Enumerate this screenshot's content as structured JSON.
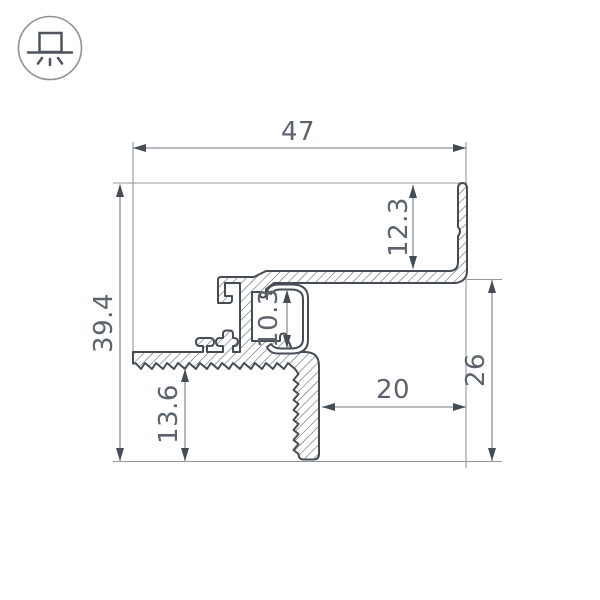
{
  "drawing": {
    "type": "profile-cross-section",
    "icon": "recessed-light-icon",
    "dimensions": {
      "total_width": "47",
      "total_height": "39.4",
      "back_wall_height": "12.3",
      "channel_opening": "10.3",
      "flange_to_base": "13.6",
      "leg_inset": "20",
      "right_drop": "26"
    },
    "colors": {
      "outline": "#454c54",
      "dimension_line": "#8b9299",
      "text": "#5c636c",
      "hatch": "#5b6268",
      "icon_circle": "#8b9299",
      "icon_glyph": "#4d545c",
      "background": "#ffffff"
    }
  }
}
